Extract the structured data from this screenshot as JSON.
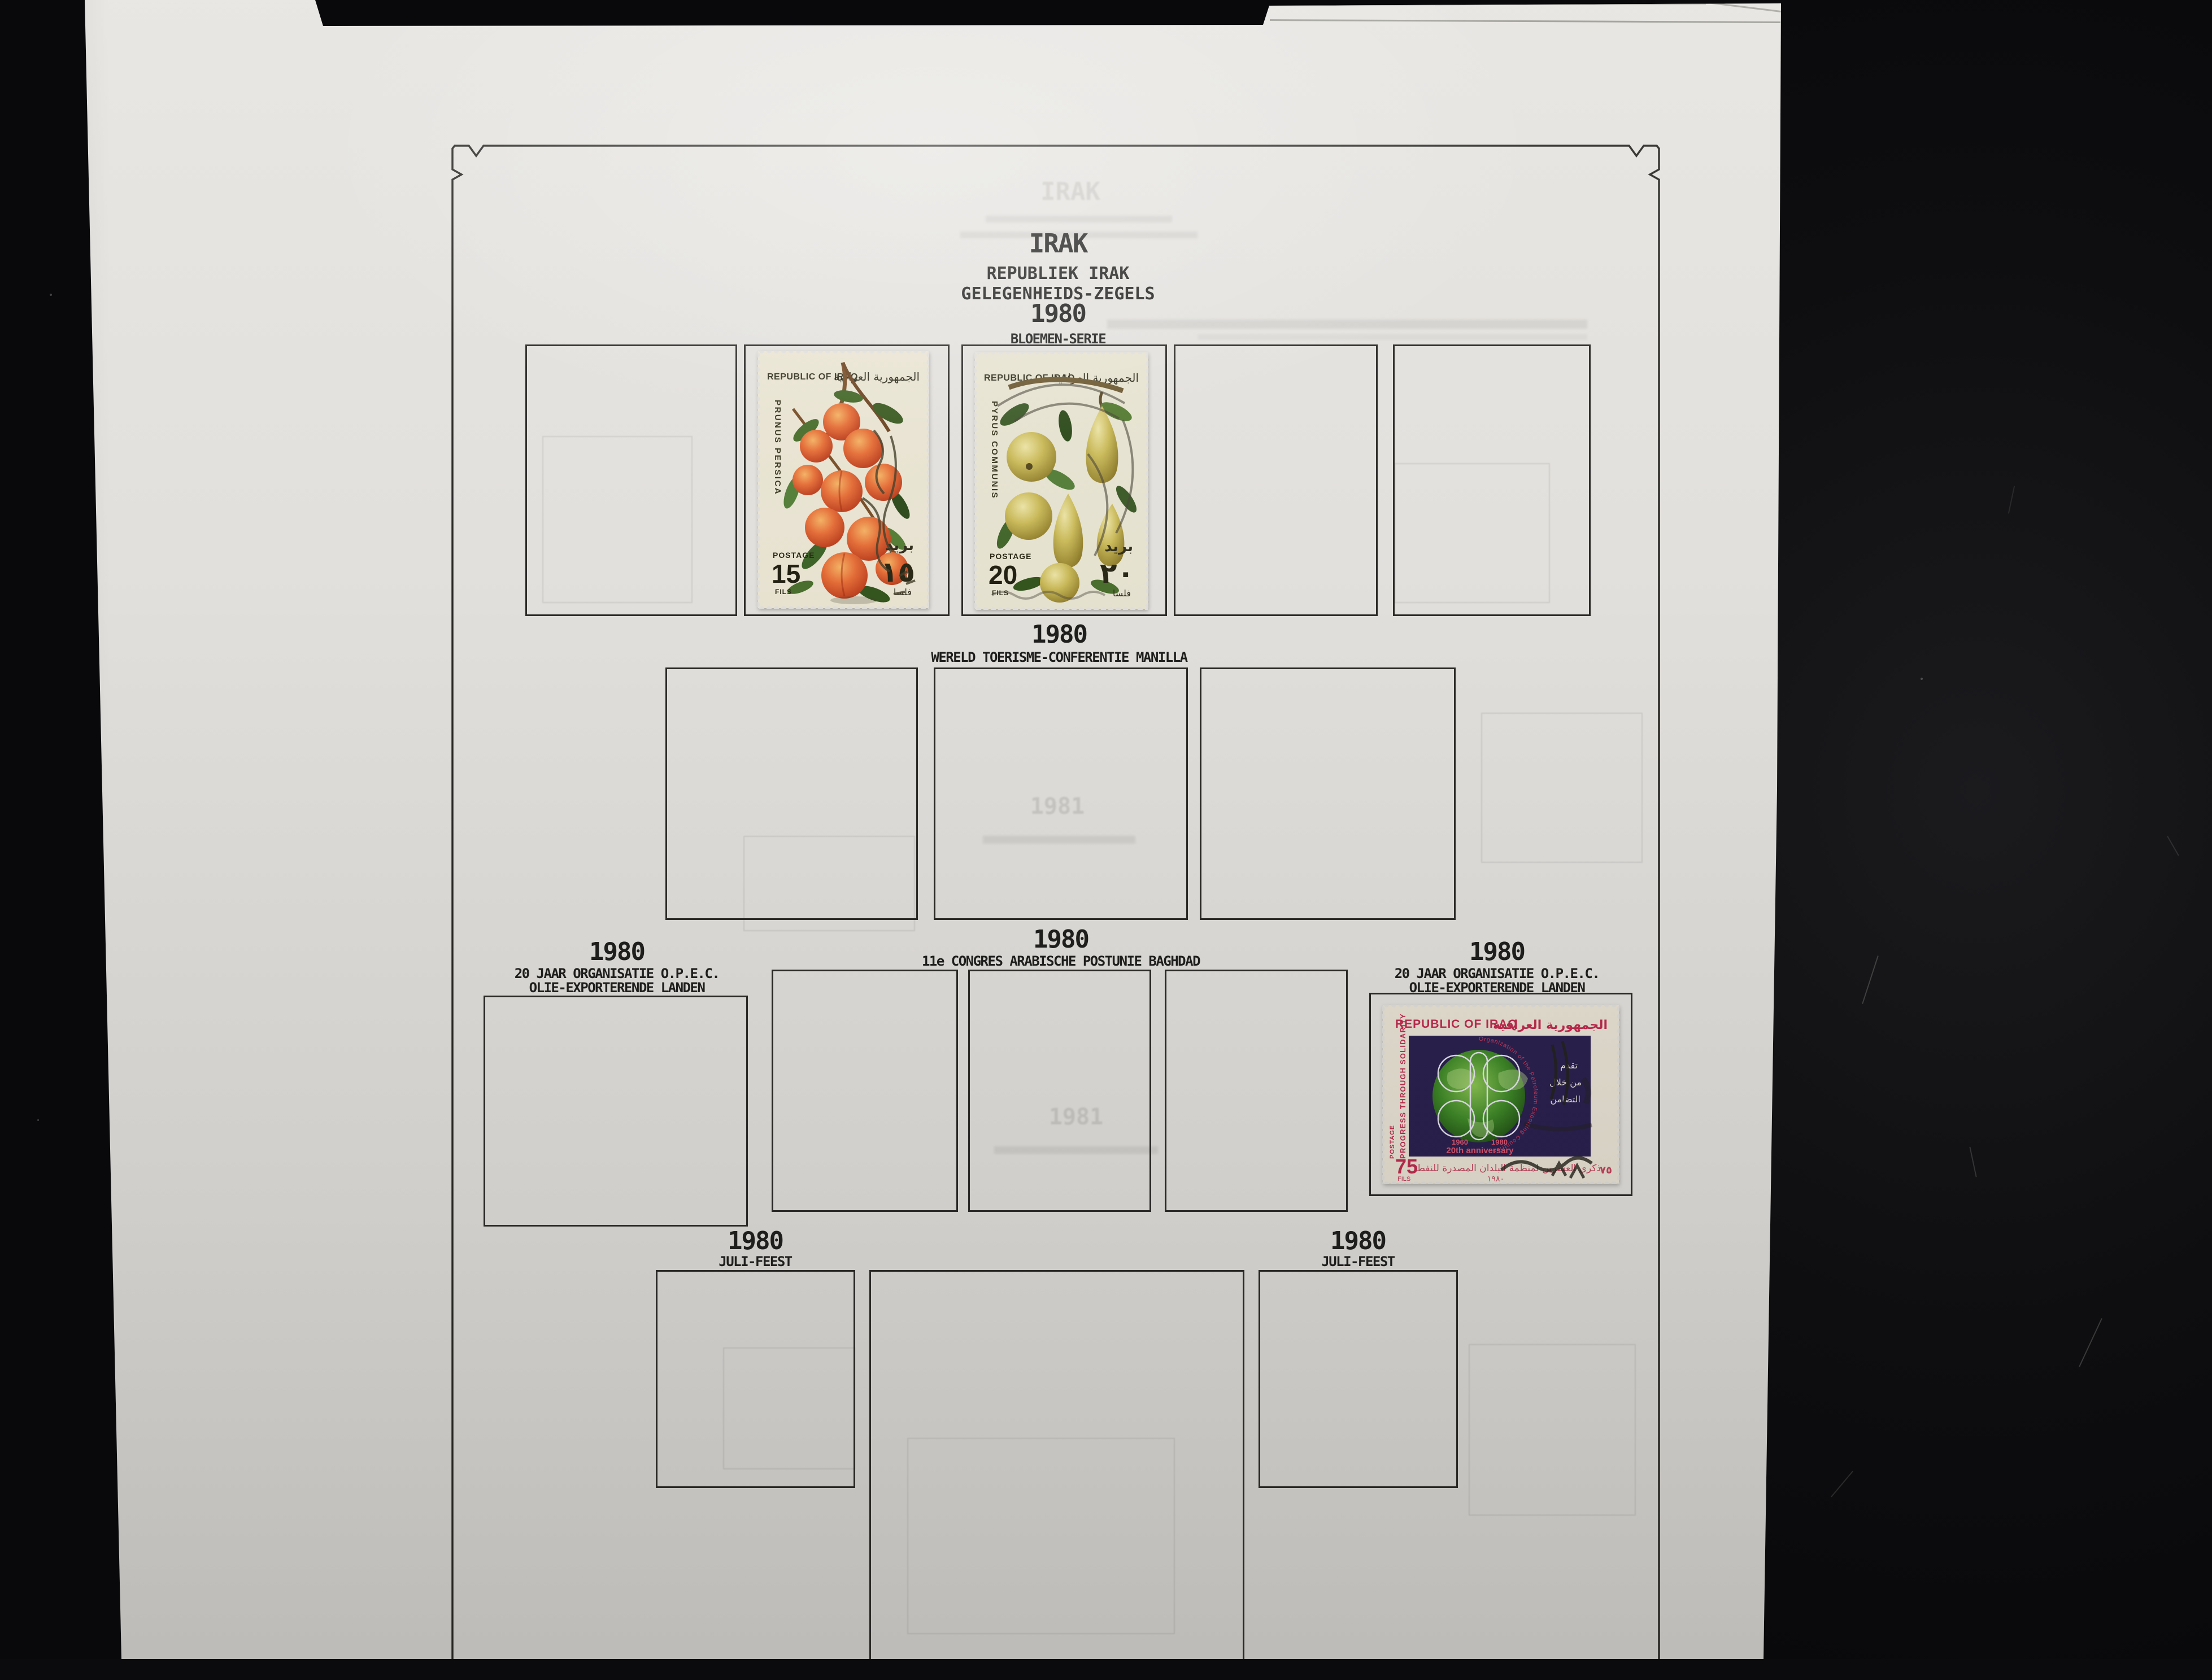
{
  "album": {
    "title": "IRAK",
    "subtitle1": "REPUBLIEK IRAK",
    "subtitle2": "GELEGENHEIDS-ZEGELS",
    "ghost_year": "1981",
    "sections": [
      {
        "year": "1980",
        "label": "BLOEMEN-SERIE"
      },
      {
        "year": "1980",
        "label": "WERELD TOERISME-CONFERENTIE MANILLA"
      },
      {
        "year": "1980",
        "line1": "20 JAAR ORGANISATIE O.P.E.C.",
        "line2": "OLIE-EXPORTERENDE LANDEN"
      },
      {
        "year": "1980",
        "label": "11e CONGRES ARABISCHE POSTUNIE BAGHDAD"
      },
      {
        "year": "1980",
        "line1": "20 JAAR ORGANISATIE O.P.E.C.",
        "line2": "OLIE-EXPORTERENDE LANDEN"
      },
      {
        "year": "1980",
        "label": "JULI-FEEST"
      },
      {
        "year": "1980",
        "label": "JULI-FEEST"
      }
    ]
  },
  "stamps": {
    "prunus": {
      "country_en": "REPUBLIC OF IRAQ",
      "country_ar": "الجمهورية العراقية",
      "species": "PRUNUS PERSICA",
      "postage_label": "POSTAGE",
      "value": "15",
      "currency": "FILS",
      "postage_ar": "بريد",
      "value_ar": "١٥",
      "currency_ar": "فلسا"
    },
    "pyrus": {
      "country_en": "REPUBLIC OF IRAQ",
      "country_ar": "الجمهورية العراقية",
      "species": "PYRUS COMMUNIS",
      "postage_label": "POSTAGE",
      "value": "20",
      "currency": "FILS",
      "postage_ar": "بريد",
      "value_ar": "٢٠",
      "currency_ar": "فلسا"
    },
    "opec": {
      "country_en": "REPUBLIC OF IRAQ",
      "country_ar": "الجمهورية العراقية",
      "motto": "PROGRESS THROUGH SOLIDARITY",
      "postage_label": "POSTAGE",
      "ring_text": "Organization of the Petroleum Exporting Countries",
      "year_left": "1960",
      "year_right": "1980",
      "anniversary": "20th anniversary",
      "value": "75",
      "currency": "FILS",
      "value_ar": "٧٥",
      "side_ar_1": "تقدم",
      "side_ar_2": "من خلال",
      "side_ar_3": "التضامن",
      "bottom_ar": "ذكرى العشرين لمنظمة البلدان المصدرة للنفط",
      "bottom_year_ar": "١٩٨٠"
    }
  },
  "colors": {
    "backdrop_black": "#0e0e10",
    "page_paper": "#e6e4e0",
    "print_ink": "#1f1f1d",
    "stamp_cream": "#ece7d5",
    "stamp_red": "#c32a4e",
    "opec_panel_indigo": "#2a2050",
    "globe_green": "#3f8a28",
    "peach_orange": "#e8703a",
    "pear_yellow": "#cdbd5c"
  }
}
